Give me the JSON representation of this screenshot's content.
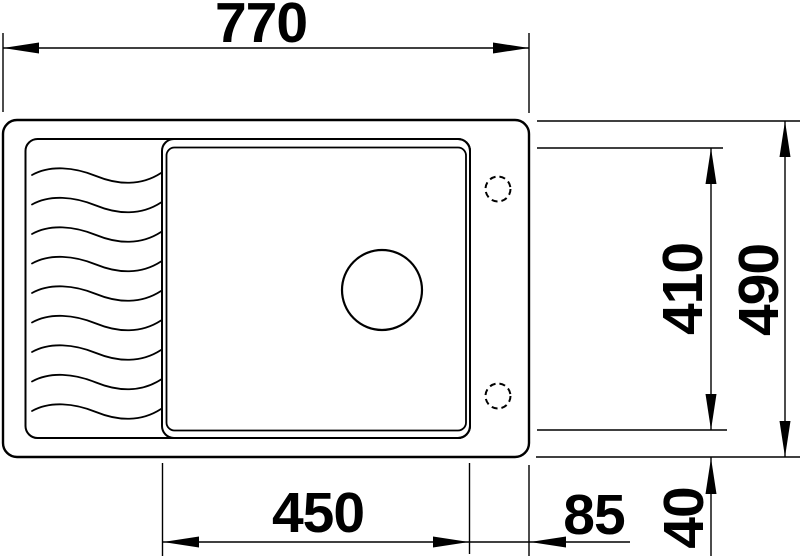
{
  "drawing": {
    "background_color": "#ffffff",
    "line_color": "#000000",
    "labels": {
      "overall_width": "770",
      "overall_depth": "490",
      "bowl_width": "450",
      "bowl_depth": "410",
      "right_ledge": "85",
      "bottom_edge": "40"
    }
  }
}
